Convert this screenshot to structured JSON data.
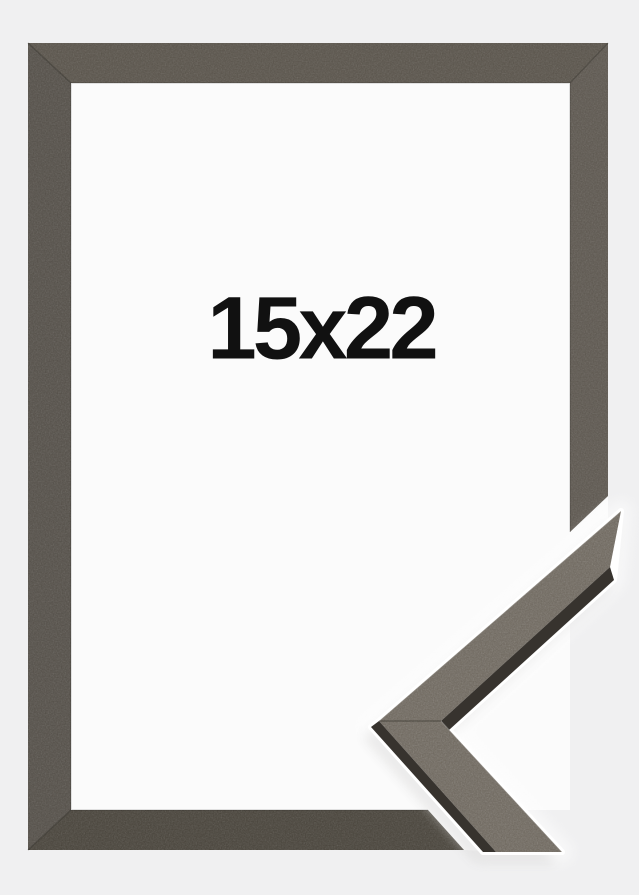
{
  "product": {
    "size_label": "15x22"
  },
  "colors": {
    "bg": "#f0f0f1",
    "inner": "#fbfbfb",
    "frame-top": "#585249",
    "frame-left": "#534e47",
    "frame-right": "#5c564e",
    "frame-bottom": "#474239",
    "sample-face": "#6e675d",
    "sample-edge": "#37332e",
    "seam": "#2a2722",
    "halo": "#ffffff",
    "text": "#111111"
  }
}
